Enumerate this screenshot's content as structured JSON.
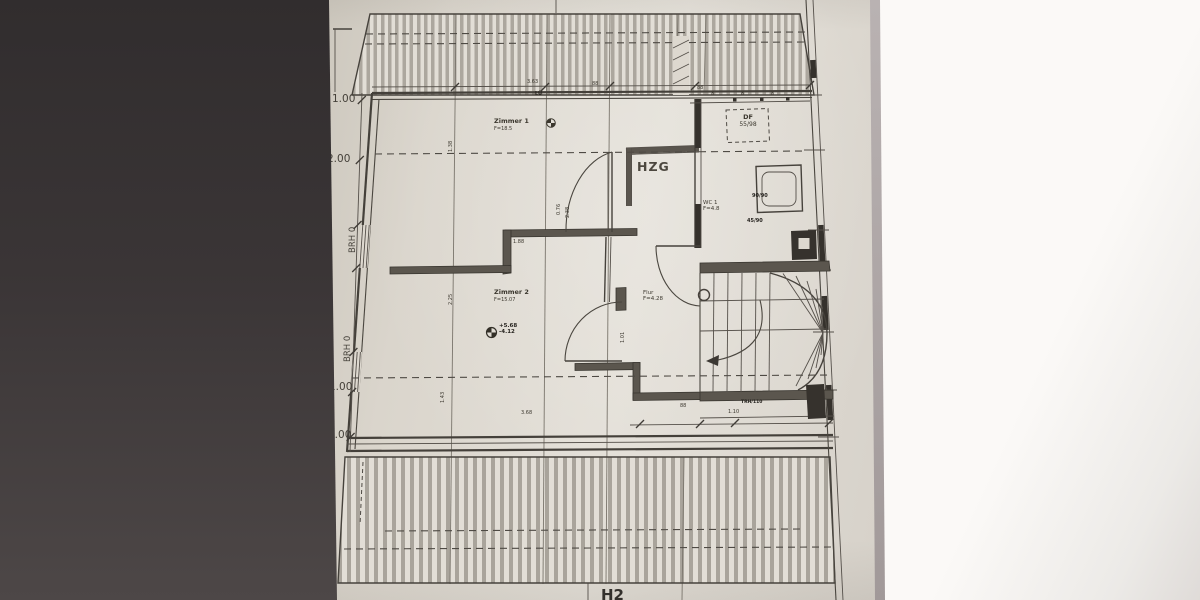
{
  "photo": {
    "page_label": "H2"
  },
  "plan": {
    "rooms": {
      "zimmer1": {
        "name": "Zimmer 1",
        "area": "F=18.5"
      },
      "zimmer2": {
        "name": "Zimmer 2",
        "area": "F=15.07"
      },
      "hzg": {
        "name": "HZG"
      },
      "wc": {
        "name": "WC 1",
        "area": "F=4.8"
      },
      "flur": {
        "name": "Flur",
        "area": "F=4.28"
      }
    },
    "annotations": {
      "roof_window_type": "DF",
      "roof_window_size": "55/98",
      "level_upper": "+5.68",
      "level_lower": "-4.12",
      "stair_note": "TRH/110",
      "fixture_label_1": "90/90",
      "fixture_label_2": "45/90",
      "vent_label": "LÜ"
    },
    "left_dimensions": [
      "1.00",
      "2.00",
      "BRH 0",
      "BRH 0",
      "1.00",
      "1.00"
    ],
    "tiny_dims": [
      "3.63",
      "88",
      "1.38",
      "8",
      "8",
      "8",
      "88",
      "2.25",
      "1.88",
      "0.76",
      "2.38",
      "1.43",
      "3.68",
      "88",
      "1.10",
      "1.01"
    ]
  }
}
